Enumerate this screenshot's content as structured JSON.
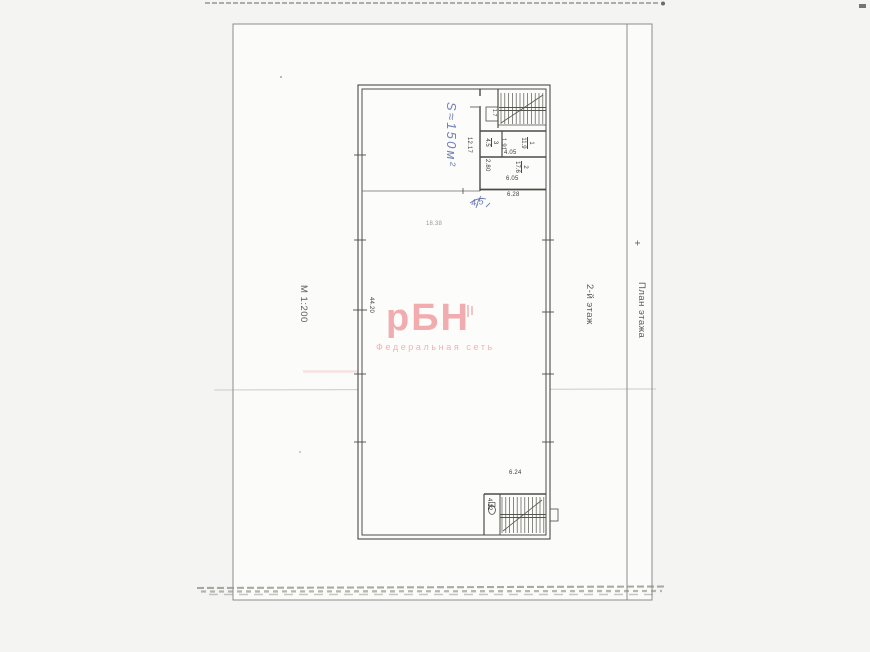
{
  "colors": {
    "watermark_pink": "#f0a8ac",
    "handwriting_blue": "#5a6cab",
    "ink": "#4b4b46",
    "paper": "#fbfbf9"
  },
  "margins": {
    "scale": "М 1:200",
    "floor": "2-й этаж",
    "column_title": "План этажа"
  },
  "watermark": {
    "brand": "рБН",
    "tagline": "Федеральная сеть"
  },
  "handwriting": {
    "area_note": "S≈150м²",
    "small_note": "4,5"
  },
  "plan": {
    "hall_area": "18.38",
    "closet_area": "1.7",
    "rooms": [
      {
        "number": "1",
        "area": "11.9"
      },
      {
        "number": "2",
        "area": "17.6"
      },
      {
        "number": "3",
        "area": "4.5"
      }
    ],
    "dims": {
      "left_inner": "12.17",
      "rooms_div": "1.91",
      "room1_width": "4.05",
      "room2_height": "2.80",
      "room2_width": "6.05",
      "block_width": "6.28",
      "hall_length": "44.20",
      "stair_width": "6.24",
      "stair_lobby": "4.12"
    }
  }
}
